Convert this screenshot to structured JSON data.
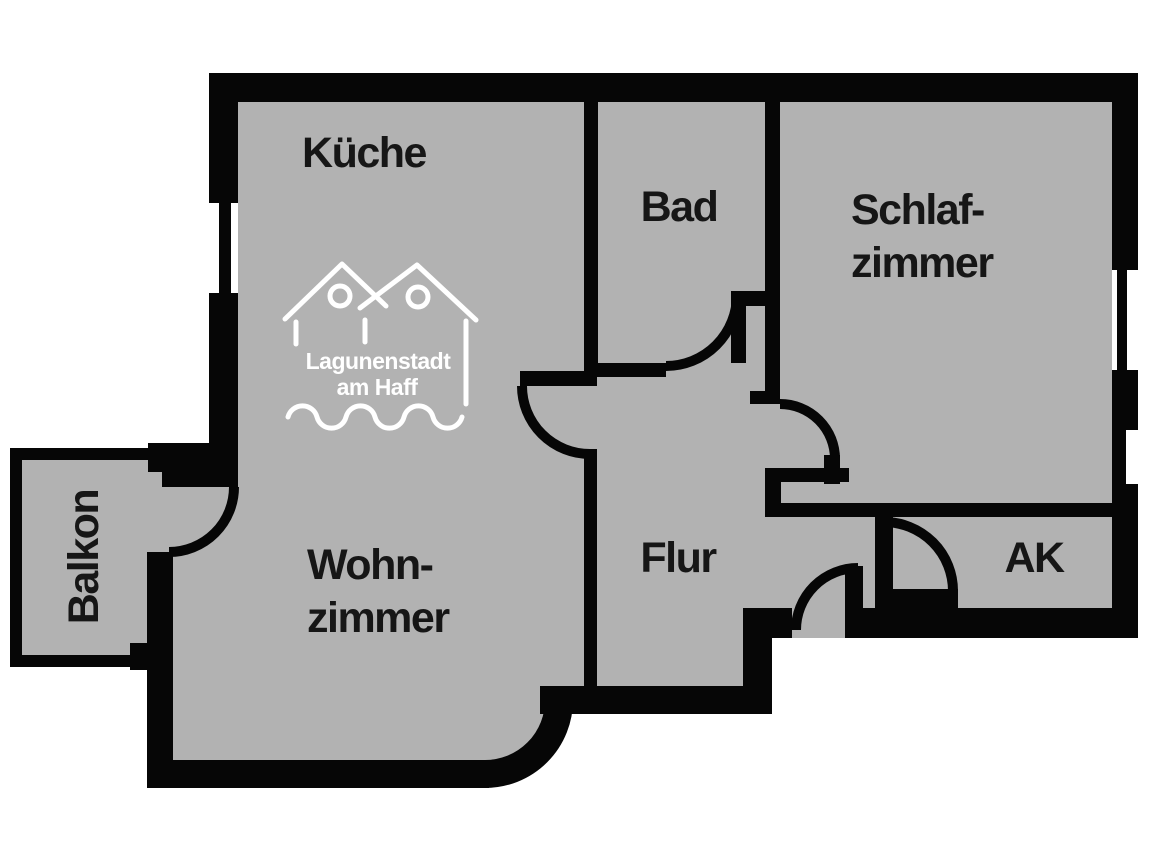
{
  "title": "Apartment floor plan",
  "colors": {
    "floor": "#b2b2b2",
    "wall": "#060606",
    "label": "#161616",
    "logo": "#ffffff",
    "background": "#ffffff"
  },
  "rooms": {
    "kueche": {
      "label": "Küche"
    },
    "bad": {
      "label": "Bad"
    },
    "schlafzimmer": {
      "lines": [
        "Schlaf-",
        "zimmer"
      ]
    },
    "wohnzimmer": {
      "lines": [
        "Wohn-",
        "zimmer"
      ]
    },
    "flur": {
      "label": "Flur"
    },
    "ak": {
      "label": "AK"
    },
    "balkon": {
      "label": "Balkon"
    }
  },
  "logo": {
    "lines": [
      "Lagunenstadt",
      "am Haff"
    ]
  }
}
